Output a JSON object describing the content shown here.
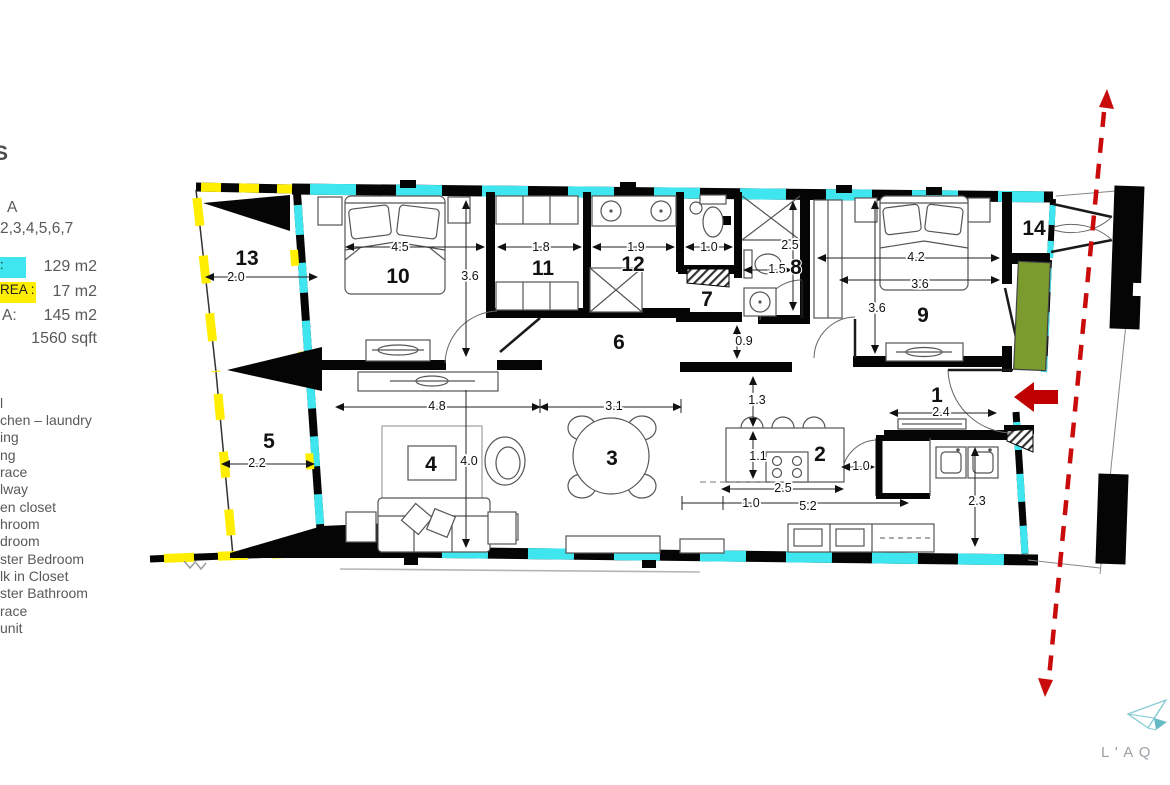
{
  "left_panel": {
    "heading_fragment": "S",
    "unit_line1": "A",
    "unit_line2": "2,3,4,5,6,7",
    "areas": [
      {
        "swatch": "cyan",
        "label_fragment": ":",
        "value": "129 m2"
      },
      {
        "swatch": "yellow",
        "label_fragment": "REA :",
        "value": "17 m2"
      },
      {
        "swatch": "none",
        "label_fragment": "A:",
        "value": "145 m2"
      },
      {
        "swatch": "none",
        "label_fragment": "",
        "value": "1560 sqft"
      }
    ],
    "legend_fragments": [
      "l",
      "chen – laundry",
      "ing",
      "ng",
      "race",
      "lway",
      "en closet",
      "hroom",
      "droom",
      "ster Bedroom",
      "lk in Closet",
      "ster Bathroom",
      "race",
      "unit"
    ]
  },
  "plan": {
    "rooms": {
      "r1": "1",
      "r2": "2",
      "r3": "3",
      "r4": "4",
      "r5": "5",
      "r6": "6",
      "r7": "7",
      "r8": "8",
      "r9": "9",
      "r10": "10",
      "r11": "11",
      "r12": "12",
      "r13": "13",
      "r14": "14"
    },
    "dims": {
      "t13_w": "2.0",
      "r10_w": "4.5",
      "r10_h": "3.6",
      "c11_w": "1.8",
      "b12_w": "1.9",
      "wc_w": "1.0",
      "b8_h": "2.5",
      "b8_w": "1.5",
      "gap": "0.9",
      "r9_w": "4.2",
      "r9_wi": "3.6",
      "r9_h": "3.6",
      "t5_w": "2.2",
      "liv_w": "4.8",
      "din_w": "3.1",
      "liv_h": "4.0",
      "k_clear": "1.3",
      "k_depth": "1.1",
      "k_island": "2.5",
      "k_run_a": "1.0",
      "k_run_b": "5.2",
      "e_w": "2.4",
      "e_closet": "1.0",
      "e_d": "2.3"
    },
    "colors": {
      "highlight_cyan": "#3fe6ef",
      "highlight_yellow": "#ffee00",
      "wall_black": "#050505",
      "planter_green": "#7c9b2f",
      "route_red": "#c00000"
    }
  },
  "logo": {
    "wordmark": "L'AQ"
  }
}
